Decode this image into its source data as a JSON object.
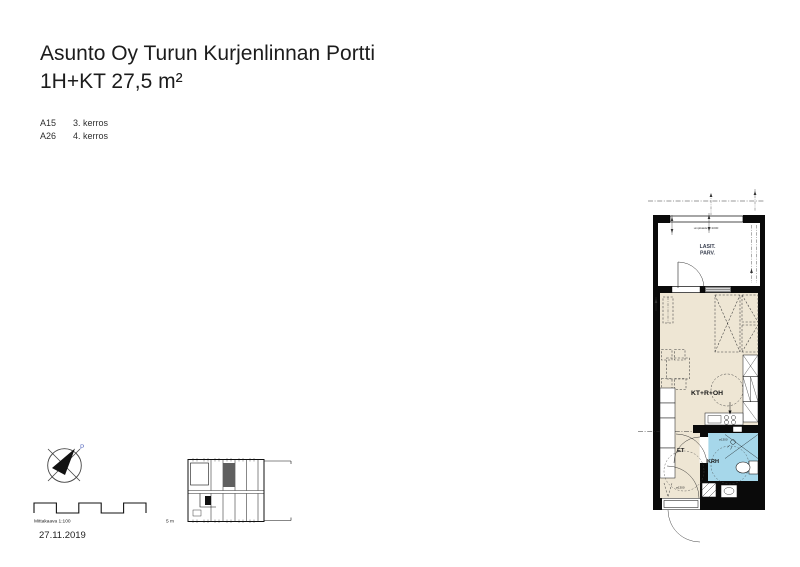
{
  "header": {
    "title_line1": "Asunto Oy Turun Kurjenlinnan Portti",
    "title_line2": "1H+KT 27,5 m²",
    "apartments": [
      {
        "id": "A15",
        "floor": "3. kerros"
      },
      {
        "id": "A26",
        "floor": "4. kerros"
      }
    ]
  },
  "plan": {
    "balcony": {
      "label_line1": "LASIT.",
      "label_line2": "PARV.",
      "railing_note": "umpikaide h=1000"
    },
    "rooms": {
      "living": "KT+R+OH",
      "hall": "ET",
      "bathroom": "KRH"
    },
    "turning_circle": "ø1300",
    "colors": {
      "floor": "#EEE6D4",
      "wet_room": "#A6D7EA",
      "wall": "#000000",
      "window": "#8C8C8C",
      "balcony_text": "#3A4050"
    }
  },
  "footer": {
    "compass_north": "P",
    "scale_label": "Mittakaava 1:100",
    "scale_end_label": "5 m",
    "date": "27.11.2019"
  }
}
